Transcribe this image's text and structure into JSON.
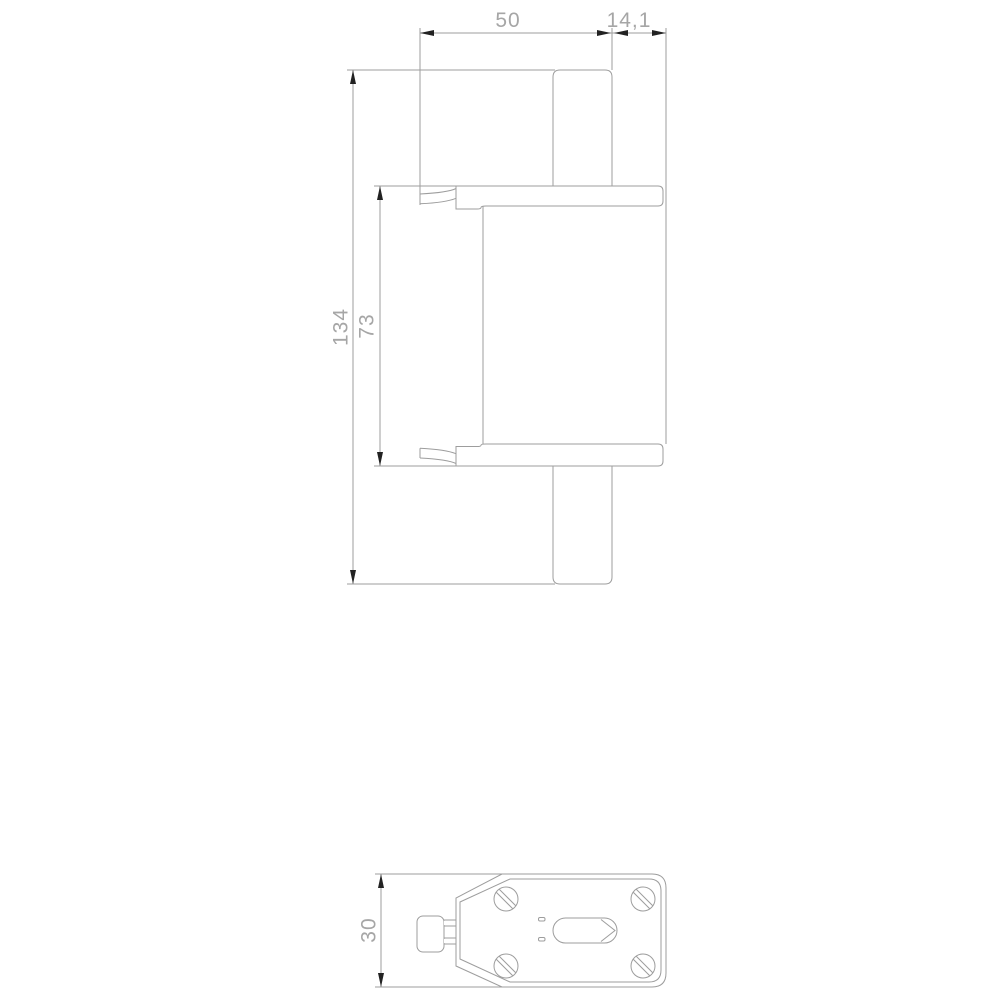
{
  "drawing": {
    "type": "technical-dimension-drawing",
    "views": {
      "side_view_name": "fuse-side-view",
      "top_view_name": "fuse-bottom-view"
    },
    "dimensions": {
      "top_width": "50",
      "top_offset": "14,1",
      "overall_height": "134",
      "body_height": "73",
      "depth": "30"
    },
    "colors": {
      "background": "#ffffff",
      "line": "#9d9d9d",
      "text": "#a6a6a6",
      "arrow": "#222222"
    }
  }
}
